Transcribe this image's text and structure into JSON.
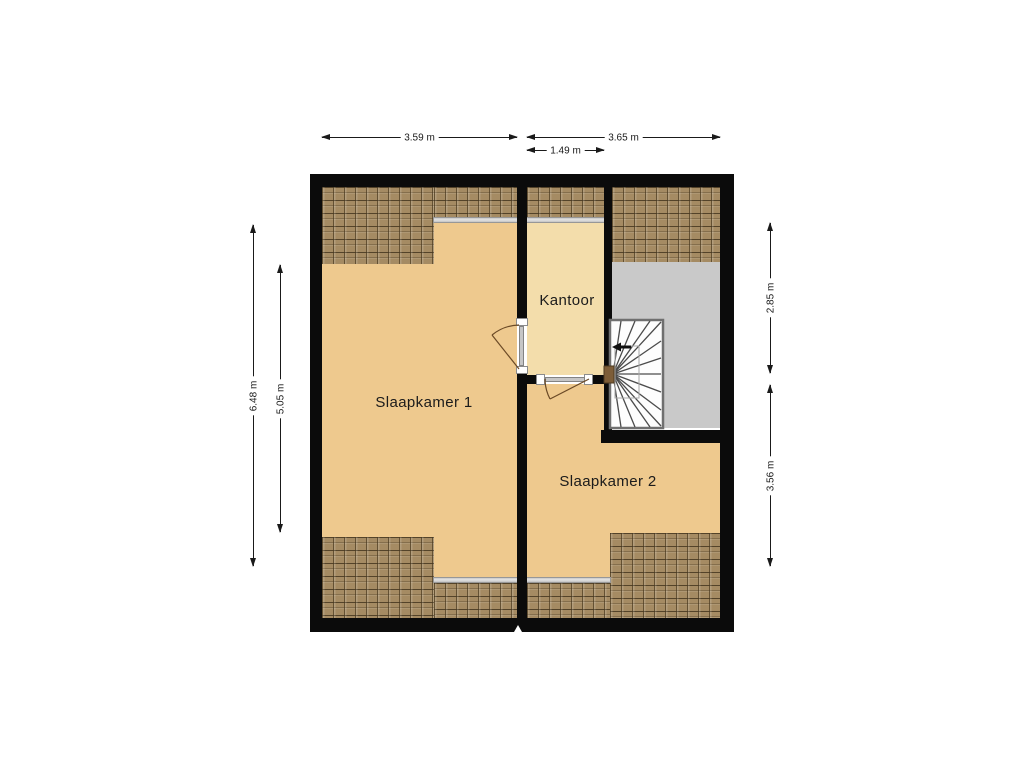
{
  "plan": {
    "type": "floorplan-attic-storey",
    "rooms": [
      {
        "label": "Slaapkamer 1"
      },
      {
        "label": "Kantoor"
      },
      {
        "label": "Slaapkamer 2"
      }
    ],
    "dimensions": {
      "top": [
        {
          "label": "3.59 m"
        },
        {
          "label": "3.65 m"
        },
        {
          "label": "1.49 m"
        }
      ],
      "left": [
        {
          "label": "6.48 m"
        },
        {
          "label": "5.05 m"
        }
      ],
      "right": [
        {
          "label": "2.85 m"
        },
        {
          "label": "3.56 m"
        }
      ]
    },
    "stair": {
      "direction_icon": "left-arrow"
    }
  },
  "colors": {
    "wall": "#0b0b0b",
    "bedroom_floor": "#eec98e",
    "office_floor": "#f3ddab",
    "landing_floor": "#c9c9c9",
    "roof_tile": "#a58b63",
    "stair_fill": "#fdfdfd",
    "dimension_line": "#1a1a1a"
  }
}
